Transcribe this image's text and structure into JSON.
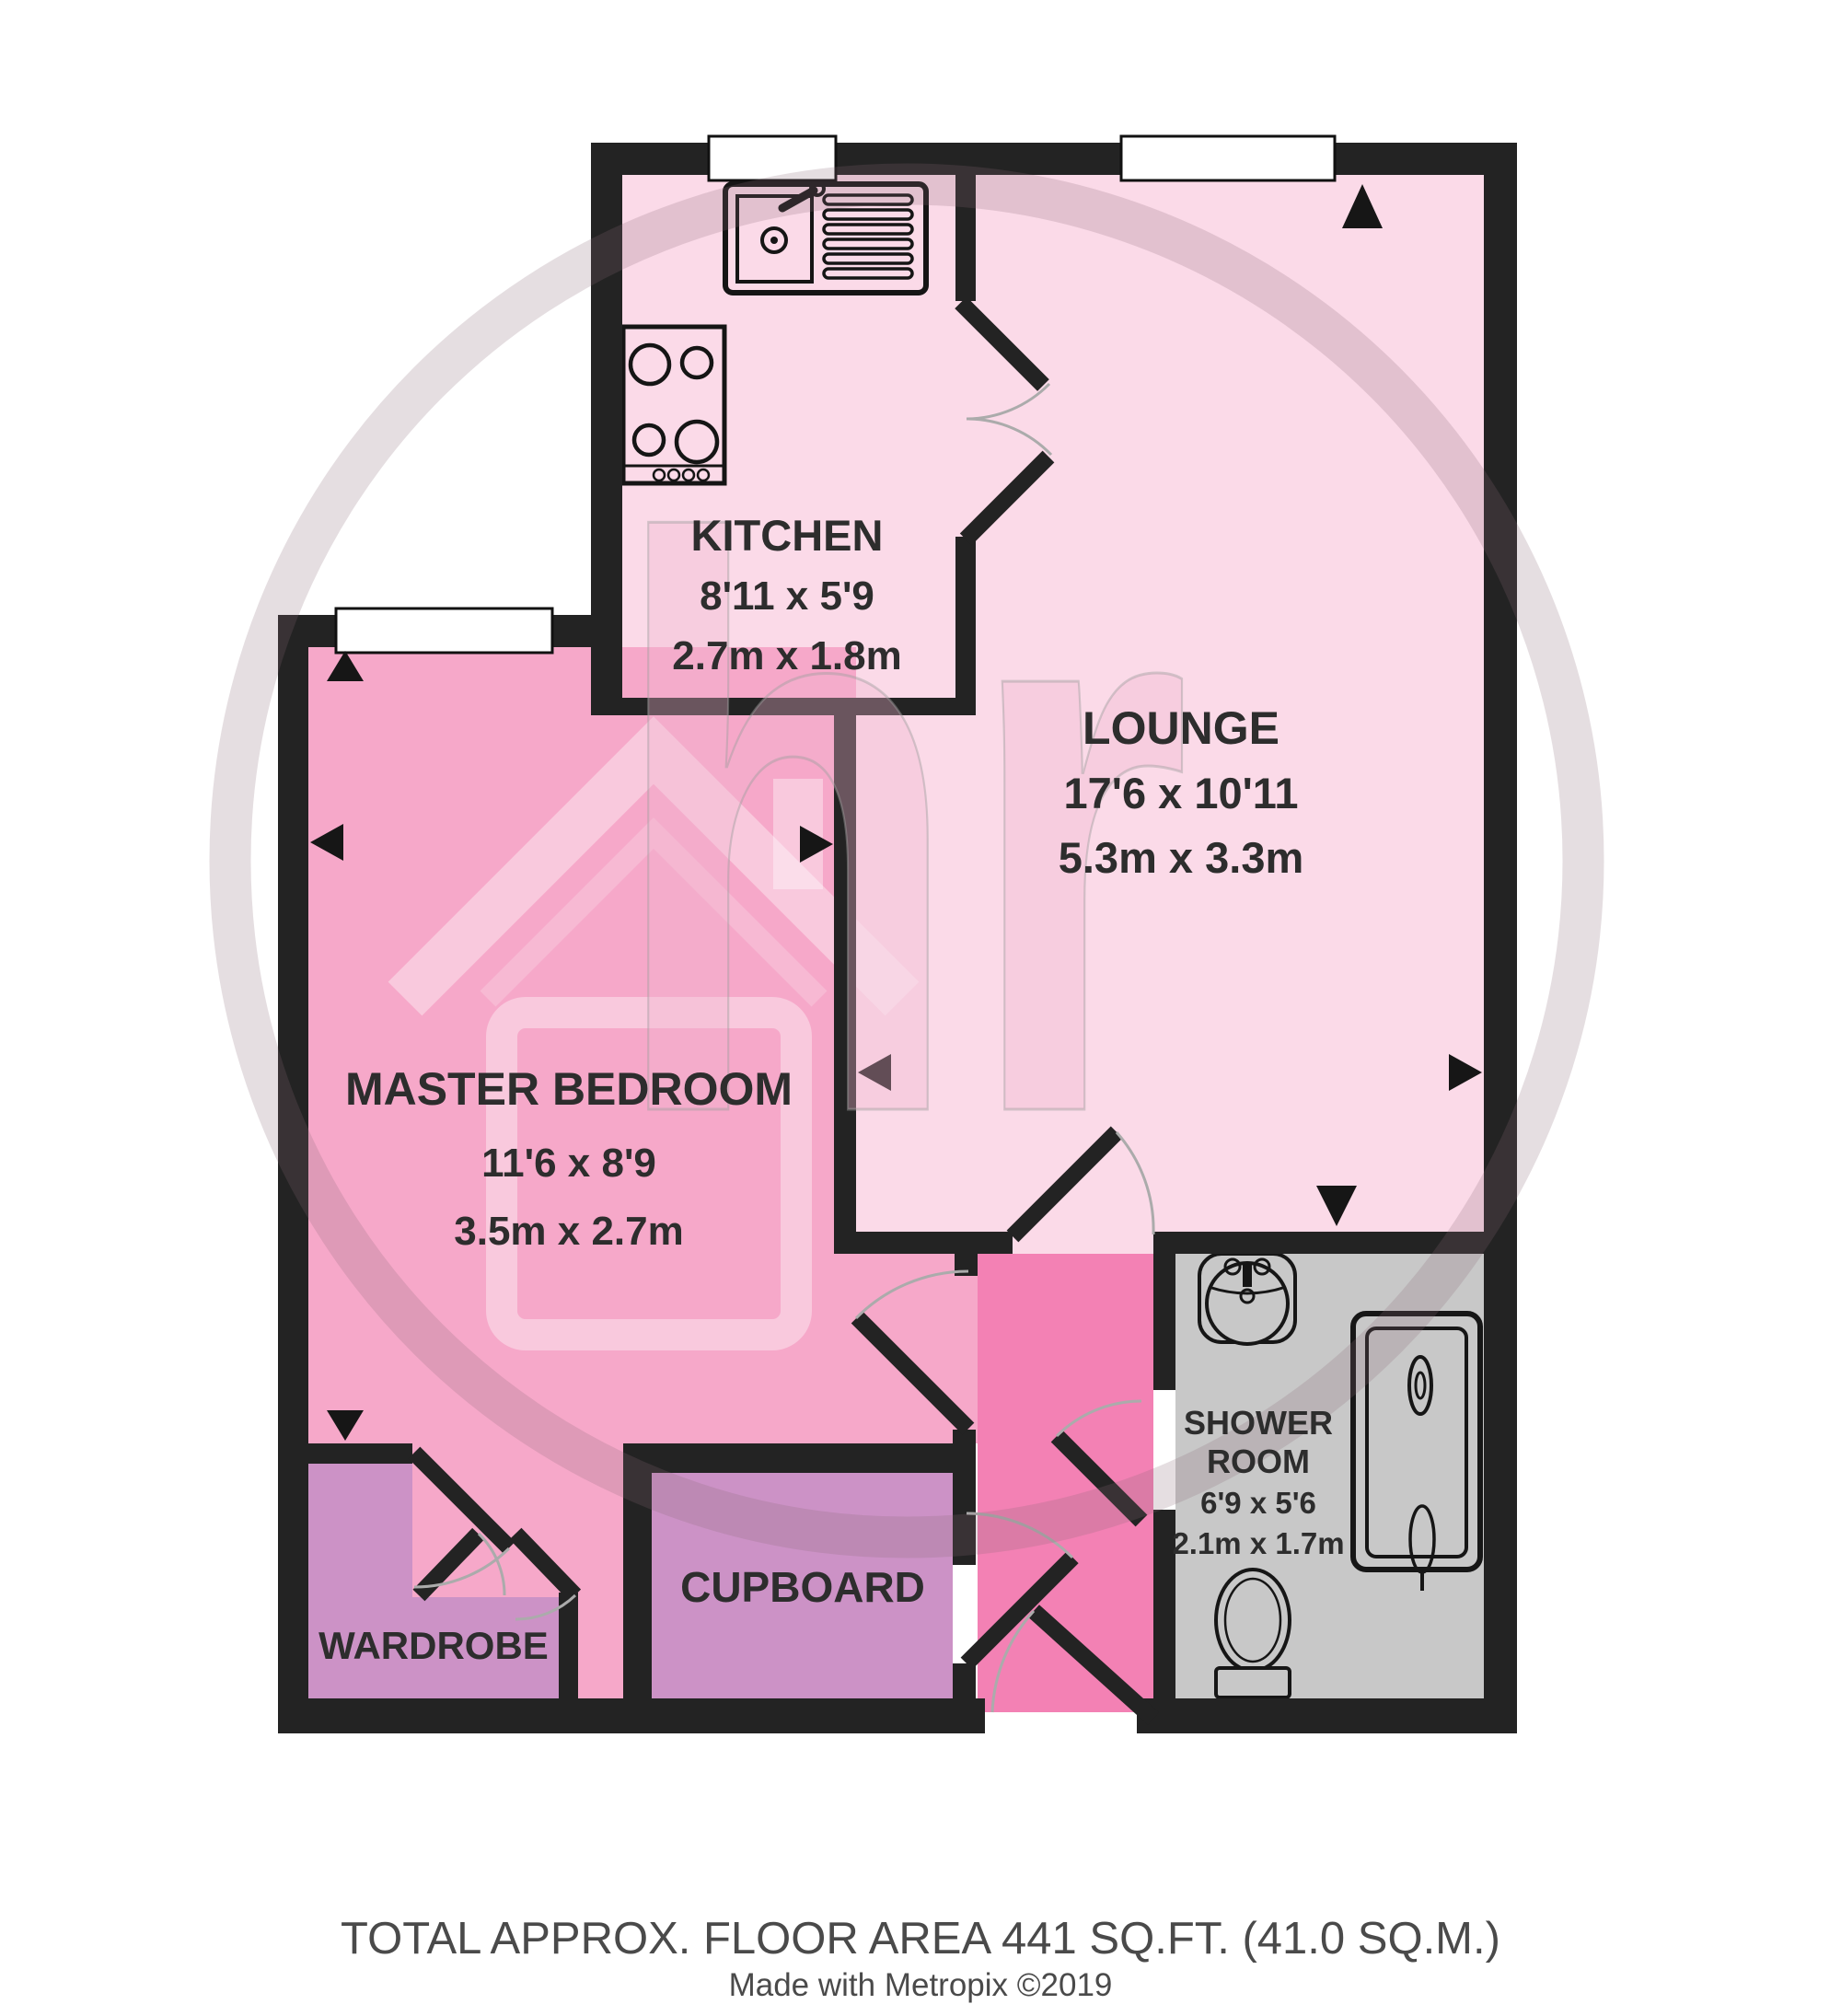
{
  "rooms": {
    "kitchen": {
      "name": "KITCHEN",
      "imperial": "8'11 x 5'9",
      "metric": "2.7m x 1.8m"
    },
    "lounge": {
      "name": "LOUNGE",
      "imperial": "17'6 x 10'11",
      "metric": "5.3m x 3.3m"
    },
    "master_bedroom": {
      "name": "MASTER BEDROOM",
      "imperial": "11'6 x 8'9",
      "metric": "3.5m x 2.7m"
    },
    "shower_room": {
      "name_line1": "SHOWER",
      "name_line2": "ROOM",
      "imperial": "6'9 x 5'6",
      "metric": "2.1m x 1.7m"
    },
    "cupboard": {
      "name": "CUPBOARD"
    },
    "wardrobe": {
      "name": "WARDROBE"
    }
  },
  "footer": {
    "total_area": "TOTAL APPROX. FLOOR AREA 441 SQ.FT. (41.0 SQ.M.)",
    "credit": "Made with Metropix ©2019"
  },
  "watermark": {
    "letters": "hr"
  },
  "palette": {
    "floor_light_pink": "#FBDAE8",
    "floor_bedroom_pink": "#F6A8C9",
    "floor_corridor_pink": "#F381B4",
    "floor_storage_mauve": "#CC92C6",
    "floor_shower_gray": "#C8C8C8",
    "wall": "#232323",
    "label_text": "#2d2d2d",
    "footer_text": "#4a4a4a"
  }
}
